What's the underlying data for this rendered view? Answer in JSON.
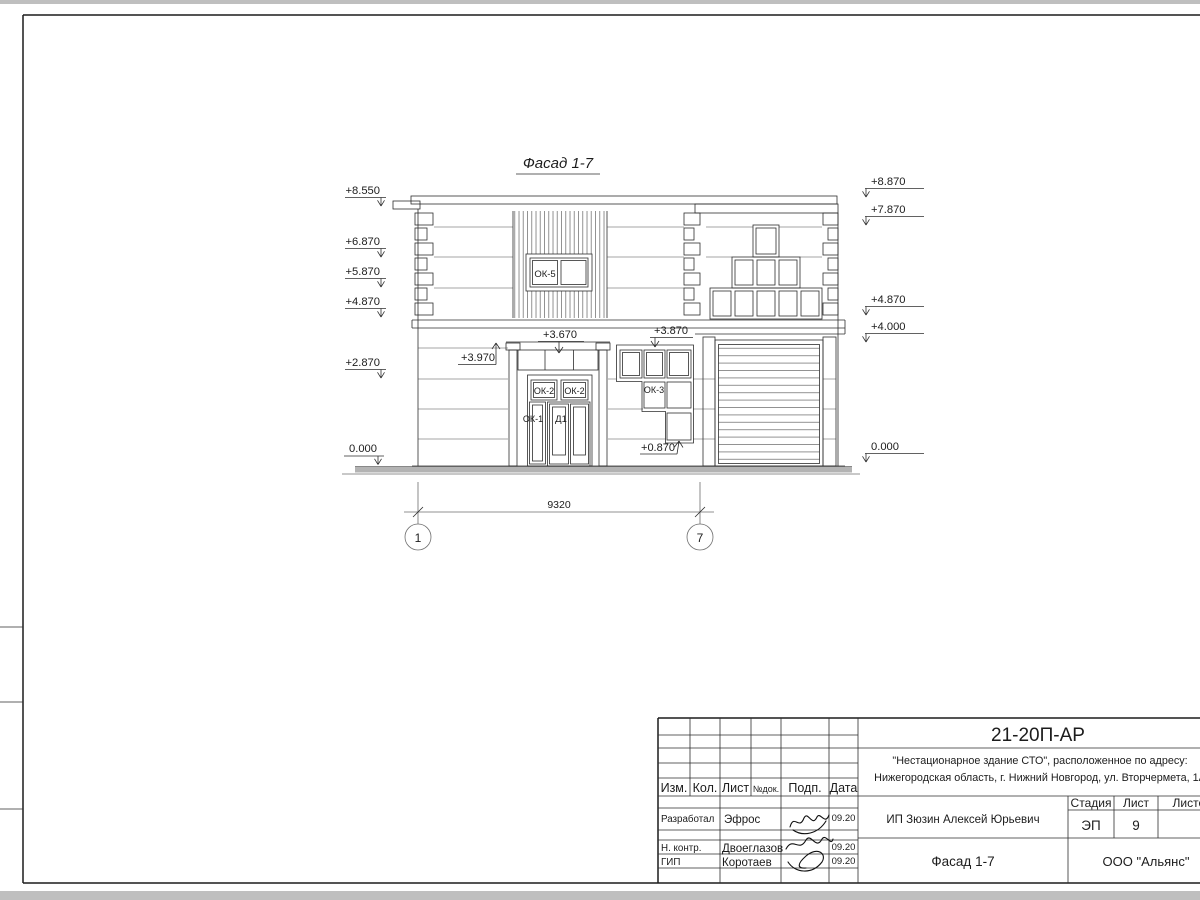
{
  "drawing": {
    "title": "Фасад 1-7",
    "dimension_label": "9320",
    "axis_labels": {
      "left": "1",
      "right": "7"
    },
    "marks_left": [
      "+8.550",
      "+6.870",
      "+5.870",
      "+4.870",
      "+2.870",
      "0.000"
    ],
    "marks_right": [
      "+8.870",
      "+7.870",
      "+4.870",
      "+4.000",
      "0.000"
    ],
    "marks_inner": {
      "pilaster": "+3.970",
      "transom": "+3.670",
      "ok3_top": "+3.870",
      "ok3_bottom": "+0.870"
    },
    "labels": {
      "ok5": "ОК-5",
      "ok2_left": "ОК-2",
      "ok2_right": "ОК-2",
      "ok1": "ОК-1",
      "d1": "Д1",
      "ok3": "ОК-3"
    }
  },
  "title_block": {
    "doc_number": "21-20П-АР",
    "project_line1": "\"Нестационарное здание СТО\", расположенное по адресу:",
    "project_line2": "Нижегородская область, г. Нижний Новгород, ул. Вторчермета, 1А",
    "client": "ИП Зюзин Алексей Юрьевич",
    "sheet_name": "Фасад 1-7",
    "organization": "ООО \"Альянс\"",
    "headers": {
      "izm": "Изм.",
      "kol": "Кол.",
      "list": "Лист",
      "doc": "№док.",
      "sign": "Подп.",
      "date": "Дата",
      "stage": "Стадия",
      "sheets": "Листов"
    },
    "stage_value": "ЭП",
    "sheet_value": "9",
    "rows": [
      {
        "role": "Разработал",
        "name": "Эфрос",
        "date": "09.20"
      },
      {
        "role": "Н. контр.",
        "name": "Двоеглазов",
        "date": "09.20"
      },
      {
        "role": "ГИП",
        "name": "Коротаев",
        "date": "09.20"
      }
    ]
  },
  "colors": {
    "ink": "#2e2e2e",
    "ground": "#b3b3b3",
    "page_edge": "#bfbfbf"
  }
}
